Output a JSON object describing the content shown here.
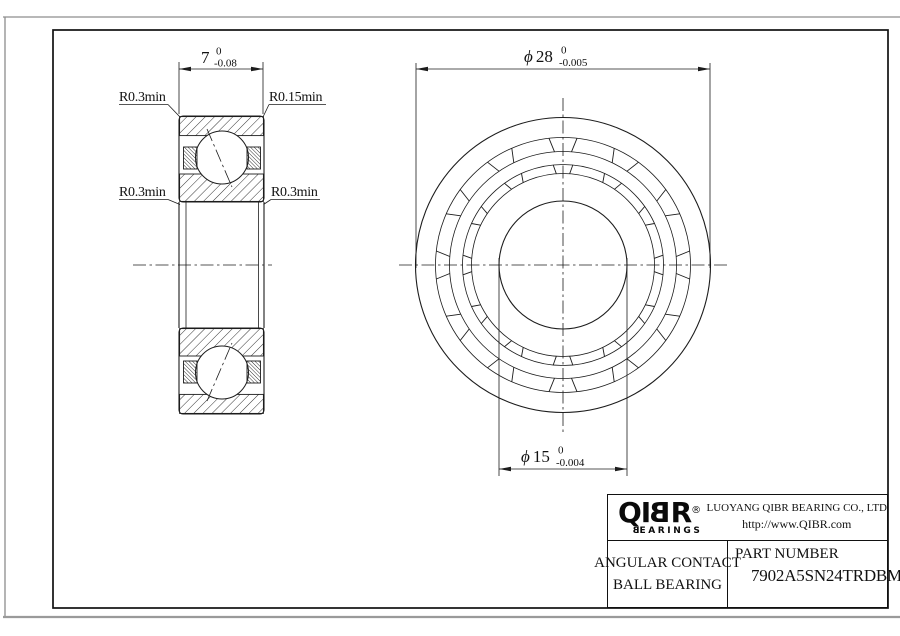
{
  "dimensions": {
    "width": {
      "value": "7",
      "tol_upper": "0",
      "tol_lower": "-0.08"
    },
    "outer_diameter": {
      "symbol": "ϕ",
      "value": "28",
      "tol_upper": "0",
      "tol_lower": "-0.005"
    },
    "bore_diameter": {
      "symbol": "ϕ",
      "value": "15",
      "tol_upper": "0",
      "tol_lower": "-0.004"
    }
  },
  "radius_labels": {
    "top_left": "R0.3min",
    "top_right": "R0.15min",
    "bottom_left": "R0.3min",
    "bottom_right": "R0.3min"
  },
  "title_block": {
    "logo": {
      "part1": "QI",
      "part2": "B",
      "part3": "R",
      "reg": "®",
      "sub_first": "B",
      "sub_rest": "EARINGS"
    },
    "company": "LUOYANG QIBR BEARING CO., LTD",
    "website": "http://www.QIBR.com",
    "product_line1": "ANGULAR CONTACT",
    "product_line2": "BALL BEARING",
    "part_number_label": "PART NUMBER",
    "part_number": "7902A5SN24TRDBMP4"
  },
  "colors": {
    "line": "#1c1c1c",
    "frame": "#111111",
    "paper_edge": "#8d8d8d"
  }
}
